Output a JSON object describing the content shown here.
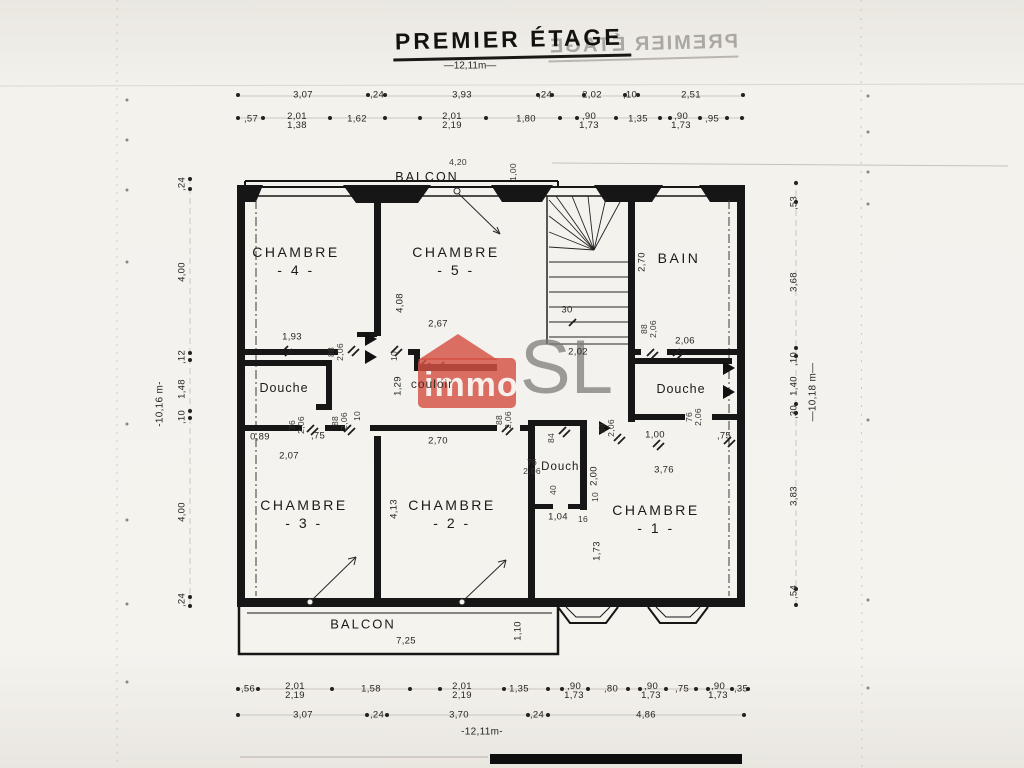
{
  "title": "PREMIER ÉTAGE",
  "title_mirror": "PREMIER ÉTAGE",
  "scales": {
    "top": "—12,11m—",
    "bottom": "-12,11m-",
    "left": "-10,16 m-",
    "right": "—10,18 m—"
  },
  "watermark": {
    "immo": "immo",
    "sl": "SL",
    "red": "#d55144",
    "gray": "#8f8d8a"
  },
  "rooms": {
    "balcon_top": "BALCON",
    "balcon_bottom": "BALCON",
    "chambre4_name": "CHAMBRE",
    "chambre4_no": "- 4 -",
    "chambre5_name": "CHAMBRE",
    "chambre5_no": "- 5 -",
    "bain": "BAIN",
    "douche_left": "Douche",
    "douche_center": "Douche",
    "douche_right": "Douche",
    "couloir": "couloir",
    "chambre3_name": "CHAMBRE",
    "chambre3_no": "- 3 -",
    "chambre2_name": "CHAMBRE",
    "chambre2_no": "- 2 -",
    "chambre1_name": "CHAMBRE",
    "chambre1_no": "- 1 -"
  },
  "dims_top_row1": [
    "3,07",
    ",24",
    "3,93",
    ",24",
    "2,02",
    ",10",
    "2,51"
  ],
  "dims_top_row2": [
    ",57",
    "2,01\n1,38",
    "1,62",
    "2,01\n2,19",
    "1,80",
    ",90\n1,73",
    "1,35",
    ",90\n1,73",
    ",95"
  ],
  "dims_left": [
    ",24",
    "4,00",
    ",12",
    "1,48",
    ",10",
    "4,00",
    ",24"
  ],
  "dims_right": [
    ",53",
    "3,68",
    ",10",
    "1,40",
    ",30",
    "3,83",
    ",54"
  ],
  "dims_bottom_row1": [
    ",56",
    "2,01\n2,19",
    "1,58",
    "2,01\n2,19",
    "1,35",
    ",90\n1,73",
    ",80",
    ",90\n1,73",
    ",75",
    ",90\n1,73",
    ",35"
  ],
  "dims_bottom_row2": [
    "3,07",
    ",24",
    "3,70",
    ",24",
    "4,86"
  ],
  "dims_balcon_top": {
    "w": "4,20",
    "d": "1,00"
  },
  "dims_balcon_bottom": {
    "w": "7,25",
    "d": "1,10"
  },
  "di": {
    "ch4_w": "1,93",
    "ch4_door": "88\n2,06",
    "ch5_10": "10",
    "ch5_h": "4,08",
    "ch5_w": "2,67",
    "stair_wall": "2,70",
    "stair_30": "30",
    "corr_202": "2,02",
    "bain_door": "88\n2,06",
    "bain_w": "2,06",
    "dl_door": "76\n2,06",
    "dl_w1": "0,89",
    "dl_75": ",75",
    "dl_w2": "2,07",
    "corr_h": "1,29",
    "corr_door_l": "88\n2,06",
    "corr_10": "10",
    "corr_door_r": "88\n2,06",
    "ch2_w": "2,70",
    "ch2_h": "4,13",
    "dc_84": "84",
    "dc_door": "76\n2,06",
    "dc_h": "2,00",
    "dc_40": "40",
    "dc_10": "10",
    "dc_w": "1,04",
    "dc_16": "16",
    "ch1_door": "88\n2,06",
    "dr_door": "76\n2,06",
    "dr_w": "1,00",
    "dr_75": ",75",
    "ch1_w": "3,76",
    "ch1_h": "1,73"
  }
}
